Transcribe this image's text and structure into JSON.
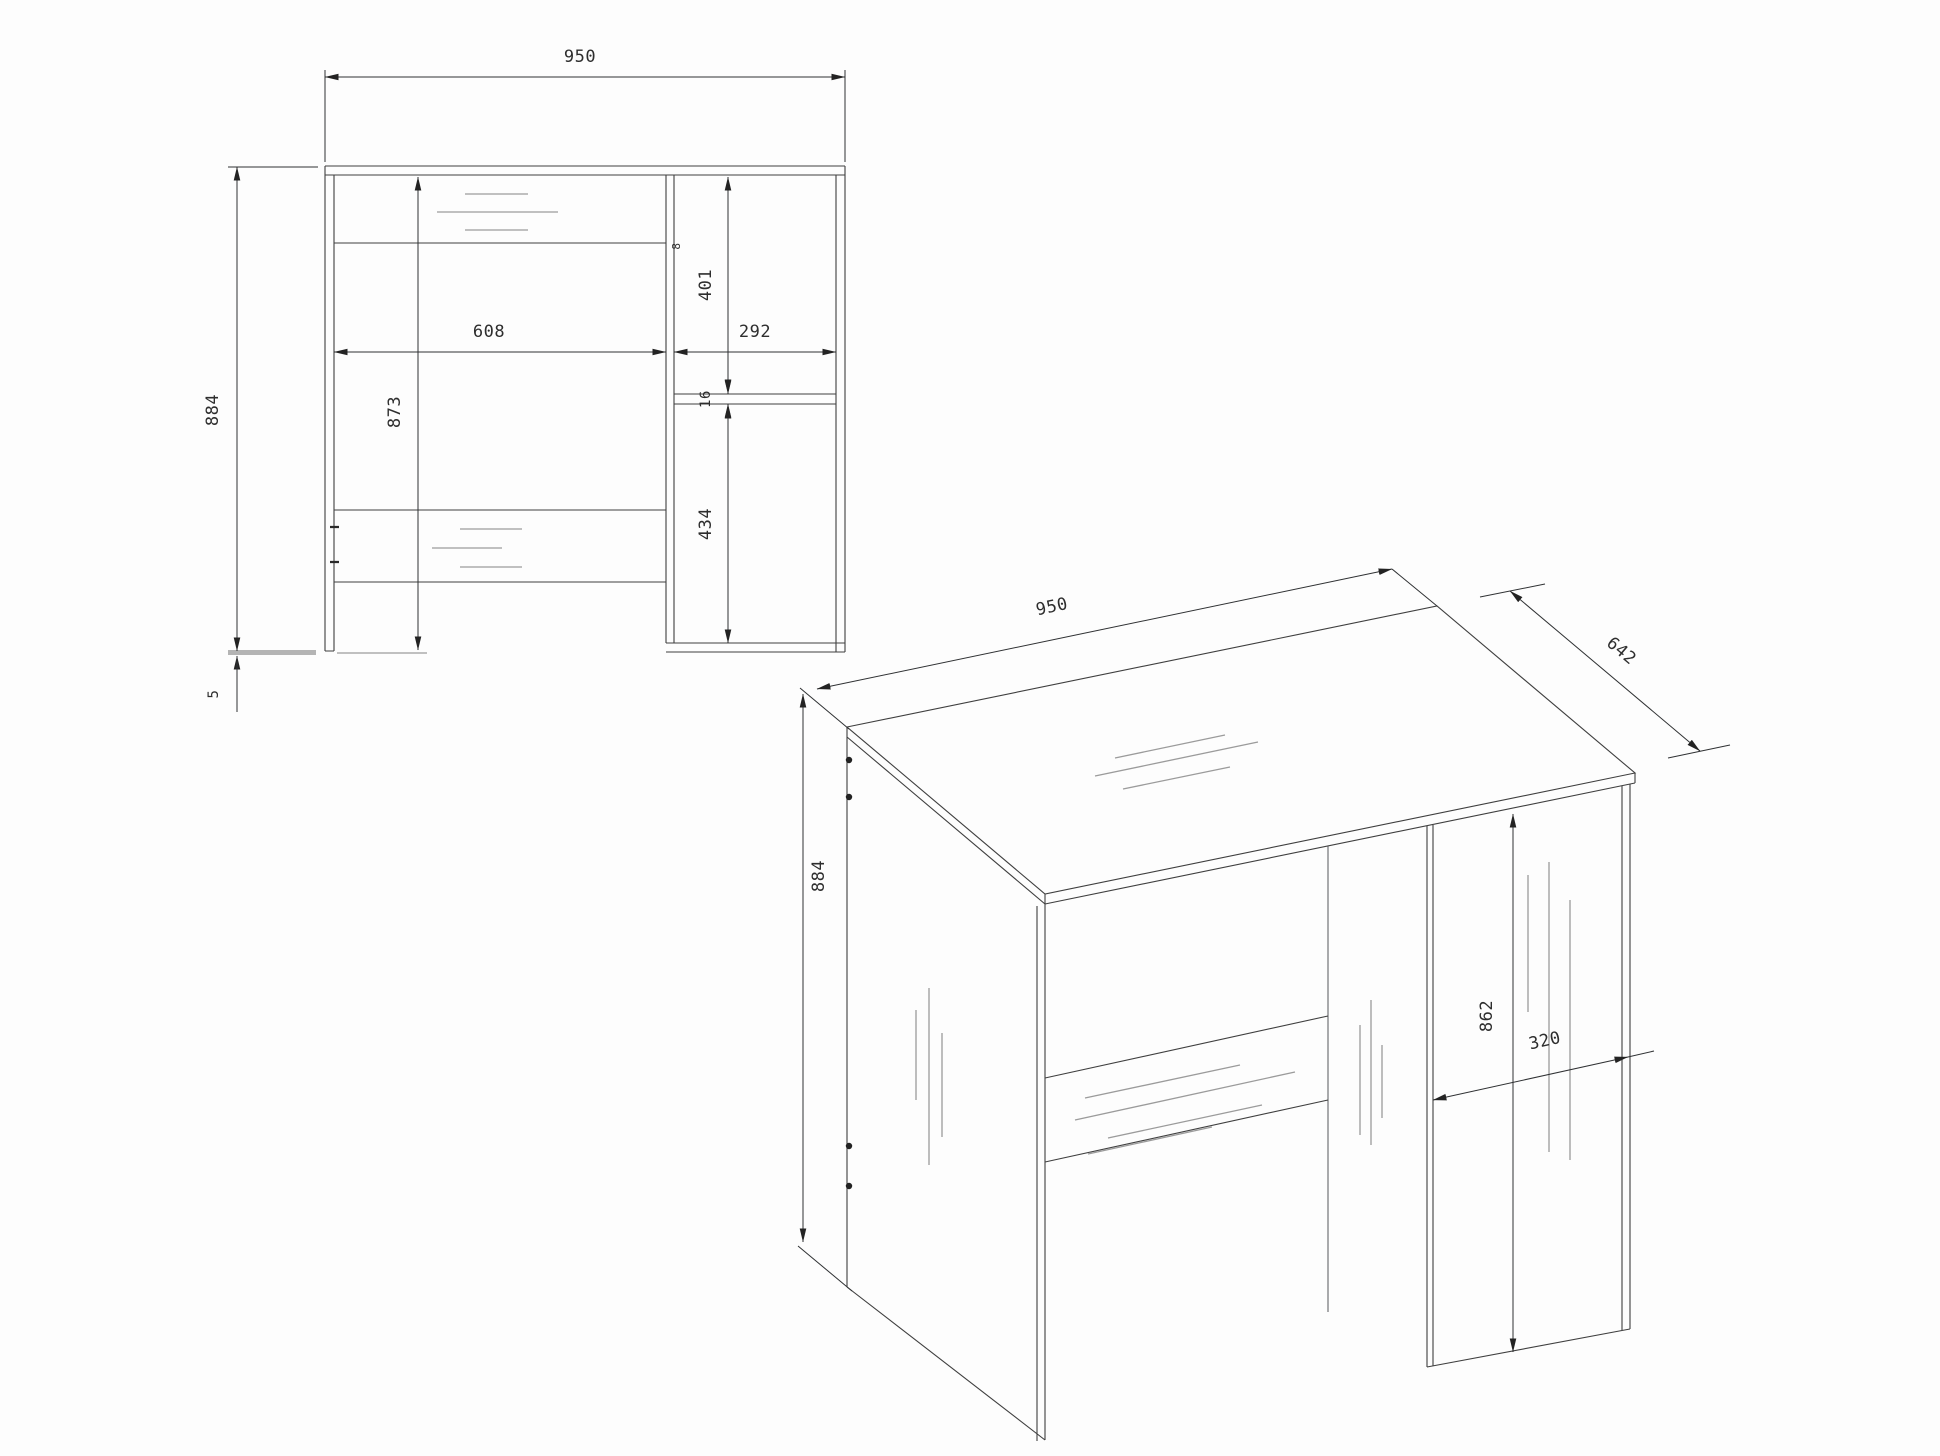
{
  "drawing": {
    "kind": "furniture technical drawing - desk, two views, line art on white",
    "front_view": {
      "dims": {
        "width": "950",
        "height": "884",
        "side_height": "873",
        "left_compartment_width": "608",
        "right_compartment_width": "292",
        "upper_right_height": "401",
        "shelf_thickness": "16",
        "lower_right_height": "434",
        "divider_thickness": "8",
        "glide_height": "5"
      }
    },
    "perspective_view": {
      "dims": {
        "width": "950",
        "depth": "642",
        "height": "884",
        "pedestal_front_height": "862",
        "pedestal_width": "320"
      }
    },
    "colors": {
      "line": "#3f3f3f",
      "dimension": "#2f3133",
      "shading": "#9b9b9b",
      "glide_bar": "#b4b4b4",
      "text": "#2e2e2e",
      "background": "#ffffff"
    }
  }
}
